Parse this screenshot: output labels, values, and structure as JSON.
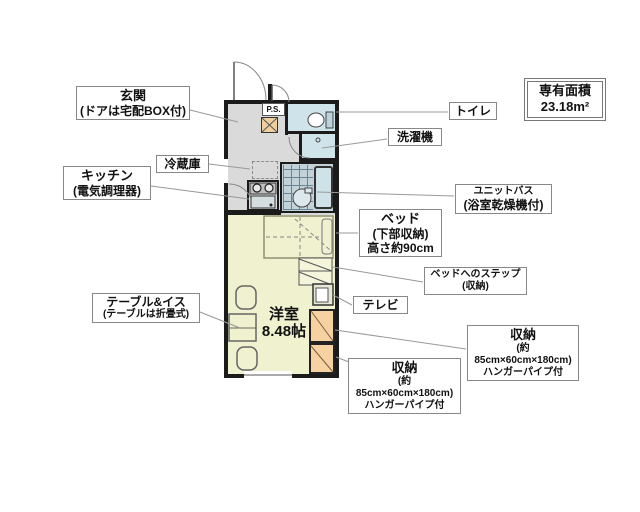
{
  "area_box": {
    "title": "専有面積",
    "value": "23.18m²"
  },
  "plan": {
    "ps": "P.S.",
    "room_name": "洋室",
    "room_size": "8.48帖"
  },
  "labels": {
    "entrance": {
      "line1": "玄関",
      "line2": "(ドアは宅配BOX付)"
    },
    "kitchen": {
      "line1": "キッチン",
      "line2": "(電気調理器)"
    },
    "refrigerator": {
      "text": "冷蔵庫"
    },
    "table_chairs": {
      "line1": "テーブル&イス",
      "line2": "(テーブルは折畳式)"
    },
    "toilet": {
      "text": "トイレ"
    },
    "washing_machine": {
      "text": "洗濯機"
    },
    "unit_bath": {
      "line1": "ユニットバス",
      "line2": "(浴室乾燥機付)"
    },
    "bed": {
      "line1": "ベッド",
      "line2": "(下部収納)",
      "line3": "高さ約90cm"
    },
    "bed_step": {
      "line1": "ベッドへのステップ",
      "line2": "(収納)"
    },
    "tv": {
      "text": "テレビ"
    },
    "storage_right": {
      "line1": "収納",
      "line2": "(約85cm×60cm×180cm)",
      "line3": "ハンガーパイプ付"
    },
    "storage_bottom": {
      "line1": "収納",
      "line2": "(約85cm×60cm×180cm)",
      "line3": "ハンガーパイプ付"
    }
  },
  "colors": {
    "wall": "#1b1b1b",
    "room_floor": "#f0f1cf",
    "hall_floor": "#dadada",
    "wet_floor": "#cfe3ea",
    "bath_tile": "#c3d2d8",
    "storage": "#f6d2a2",
    "ps_shaft": "#f0cf9f"
  }
}
